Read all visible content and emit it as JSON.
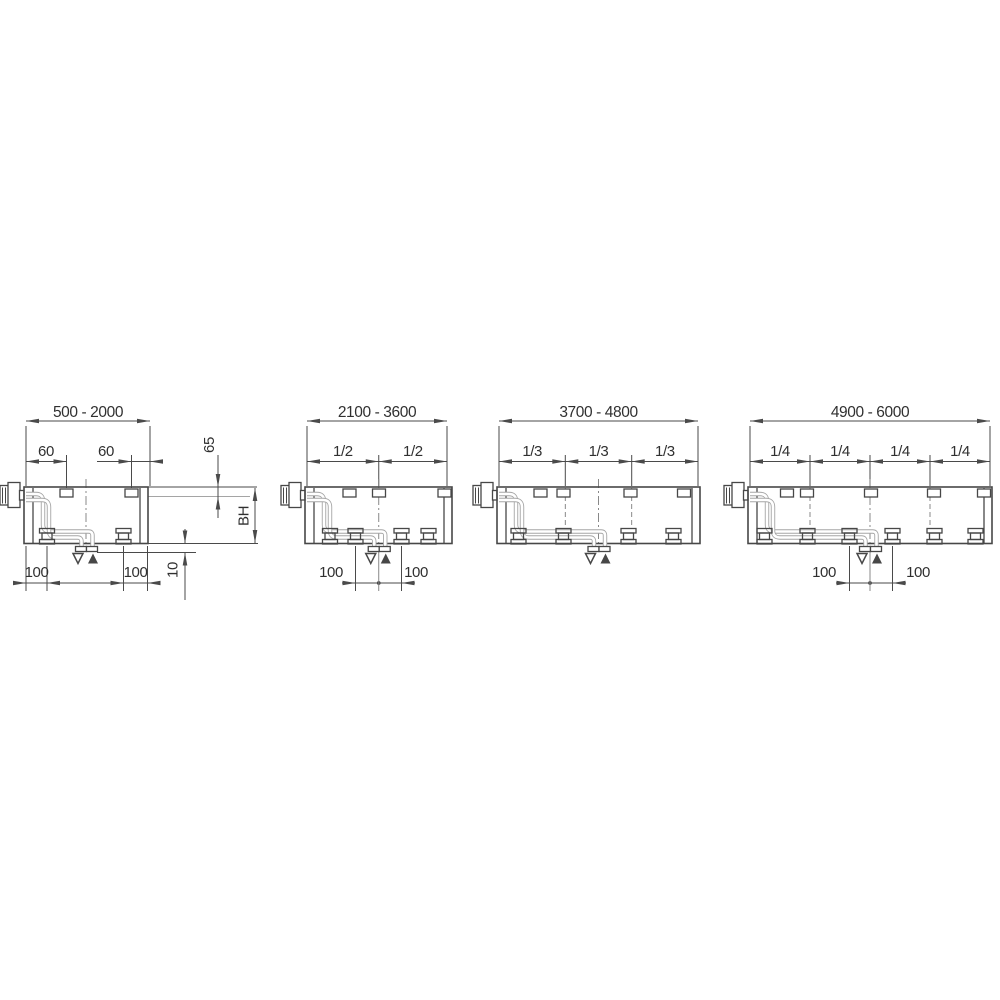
{
  "drawing_type": "technical-installation-diagram",
  "colors": {
    "background": "#ffffff",
    "outline": "#474747",
    "dimension_line": "#4a4a4a",
    "pipe": "#a5a5a5",
    "text": "#303030"
  },
  "diagrams": [
    {
      "id": "500-2000",
      "length_range": "500 - 2000",
      "top_dims": [
        "60",
        "60"
      ],
      "bottom_dims": [
        "100",
        "100"
      ],
      "side_dims": {
        "bracket_offset_from_top": "65",
        "body_height": "BH",
        "pipe_protrusion": "10"
      },
      "flow_symbols": {
        "return": "triangle-down-outline",
        "supply": "triangle-up-filled"
      },
      "bracket_count": 2,
      "clamp_count": 2
    },
    {
      "id": "2100-3600",
      "length_range": "2100 - 3600",
      "top_dims": [
        "1/2",
        "1/2"
      ],
      "bottom_dims": [
        "100",
        "100"
      ],
      "flow_symbols": {
        "return": "triangle-down-outline",
        "supply": "triangle-up-filled"
      },
      "bracket_count": 3,
      "clamp_count": 4
    },
    {
      "id": "3700-4800",
      "length_range": "3700 - 4800",
      "top_dims": [
        "1/3",
        "1/3",
        "1/3"
      ],
      "bottom_dims": [],
      "flow_symbols": {
        "return": "triangle-down-outline",
        "supply": "triangle-up-filled"
      },
      "bracket_count": 4,
      "clamp_count": 4
    },
    {
      "id": "4900-6000",
      "length_range": "4900 - 6000",
      "top_dims": [
        "1/4",
        "1/4",
        "1/4",
        "1/4"
      ],
      "bottom_dims": [
        "100",
        "100"
      ],
      "flow_symbols": {
        "return": "triangle-down-outline",
        "supply": "triangle-up-filled"
      },
      "bracket_count": 5,
      "clamp_count": 6
    }
  ]
}
